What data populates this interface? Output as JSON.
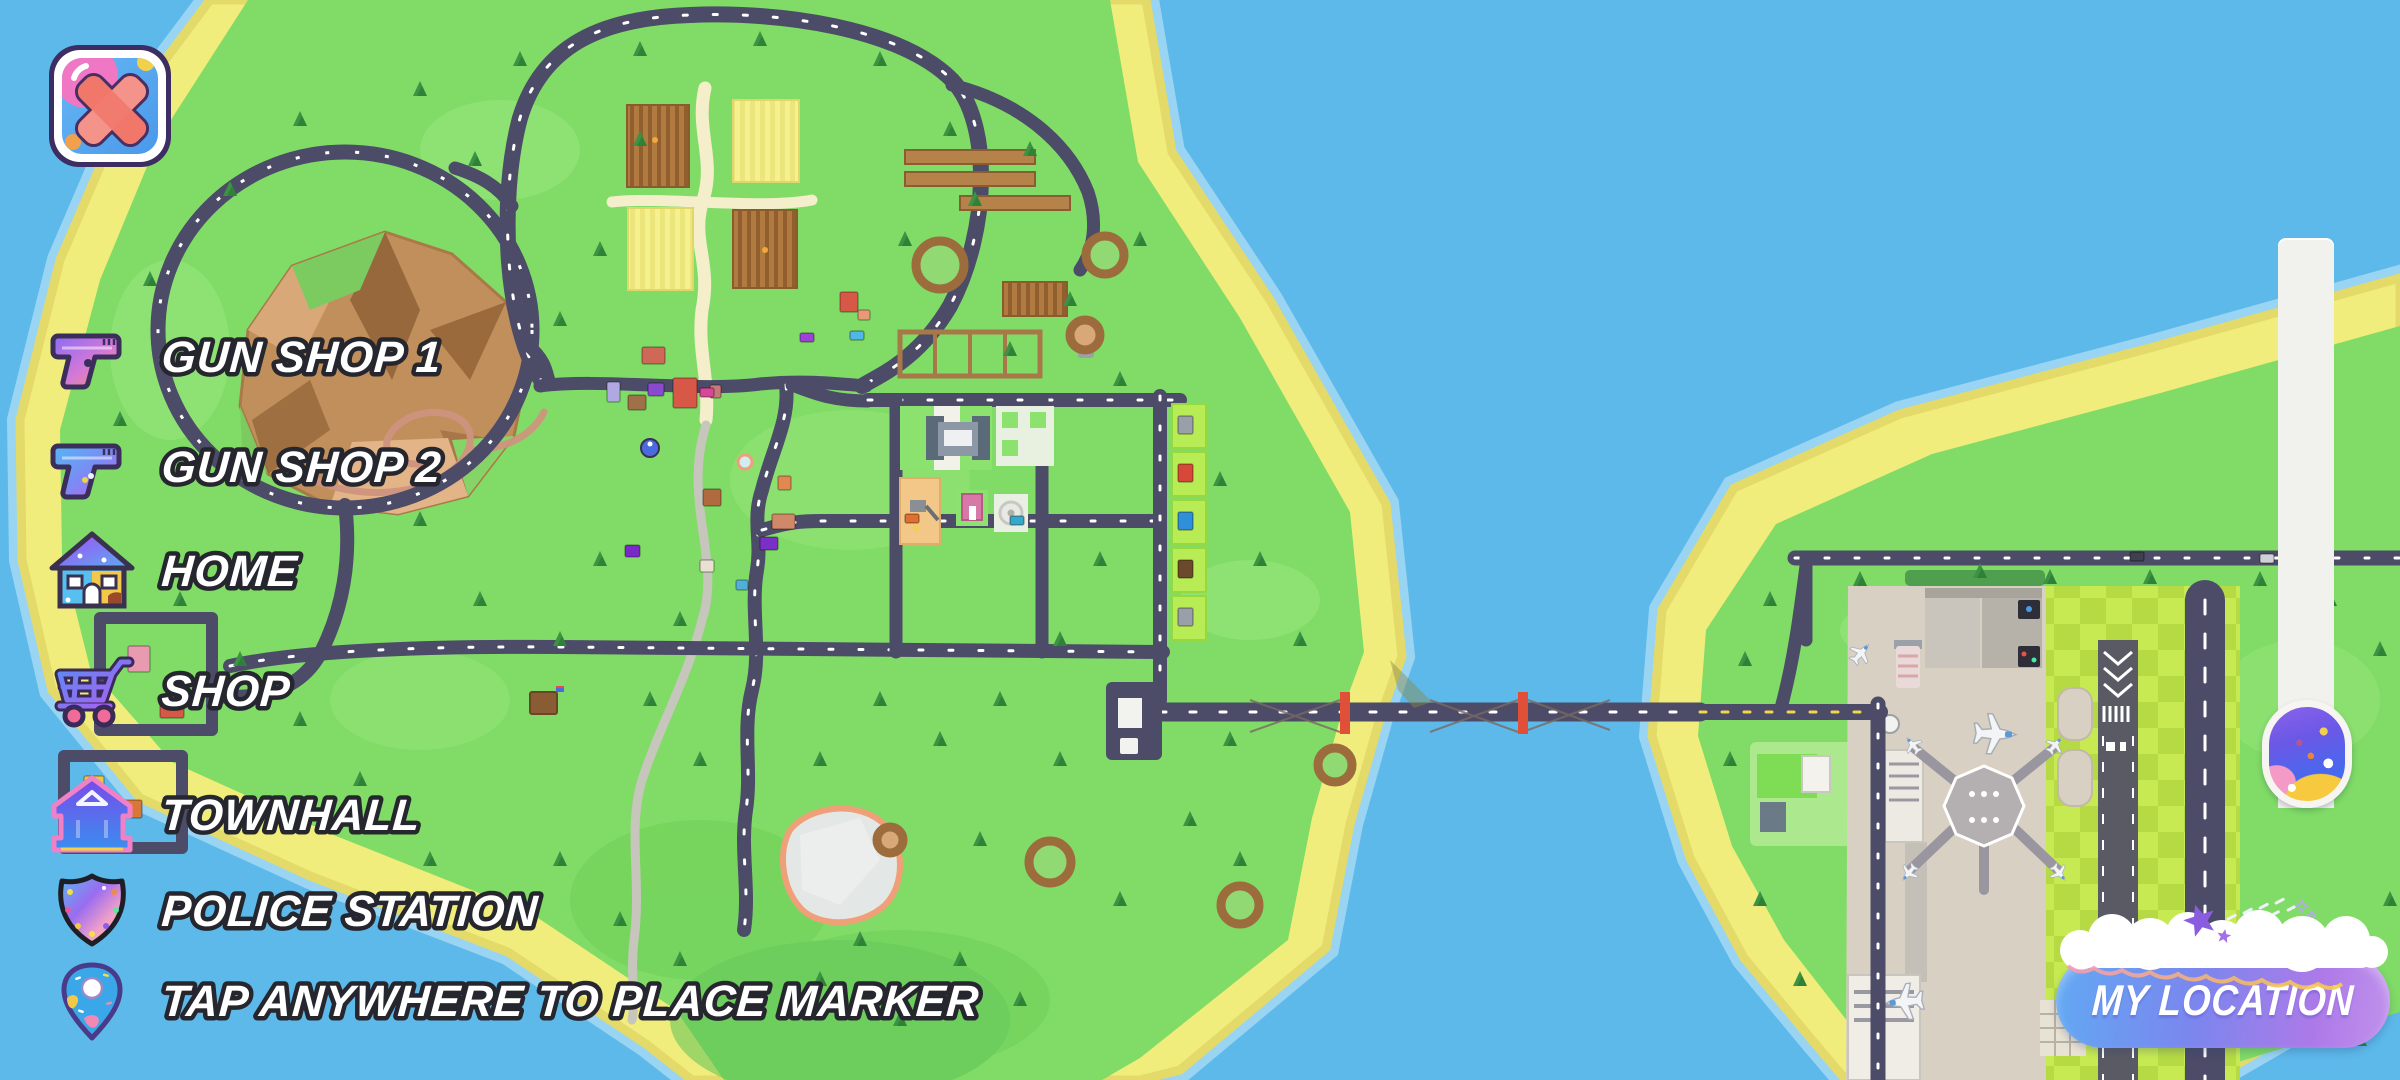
{
  "app": {
    "title": "island map screen"
  },
  "hud": {
    "close_button": {
      "icon": "x-icon"
    },
    "legend": {
      "items": [
        {
          "icon": "pistol-icon",
          "label": "GUN SHOP 1"
        },
        {
          "icon": "pistol-icon",
          "label": "GUN SHOP 2"
        },
        {
          "icon": "house-icon",
          "label": "HOME"
        },
        {
          "icon": "cart-icon",
          "label": "SHOP"
        },
        {
          "icon": "townhall-icon",
          "label": "TOWNHALL"
        },
        {
          "icon": "police-badge-icon",
          "label": "POLICE STATION"
        },
        {
          "icon": "map-pin-icon",
          "label": "TAP ANYWHERE TO PLACE MARKER"
        }
      ]
    },
    "my_location_button": {
      "label": "MY LOCATION"
    }
  },
  "colors": {
    "water": "#5db9ea",
    "sand": "#f1ed7c",
    "grass": "#80dc66",
    "road": "#4c4b68",
    "button_blue": "#64a6f2",
    "button_purple": "#ad7ae8",
    "bridge_tower_red": "#e05038"
  }
}
